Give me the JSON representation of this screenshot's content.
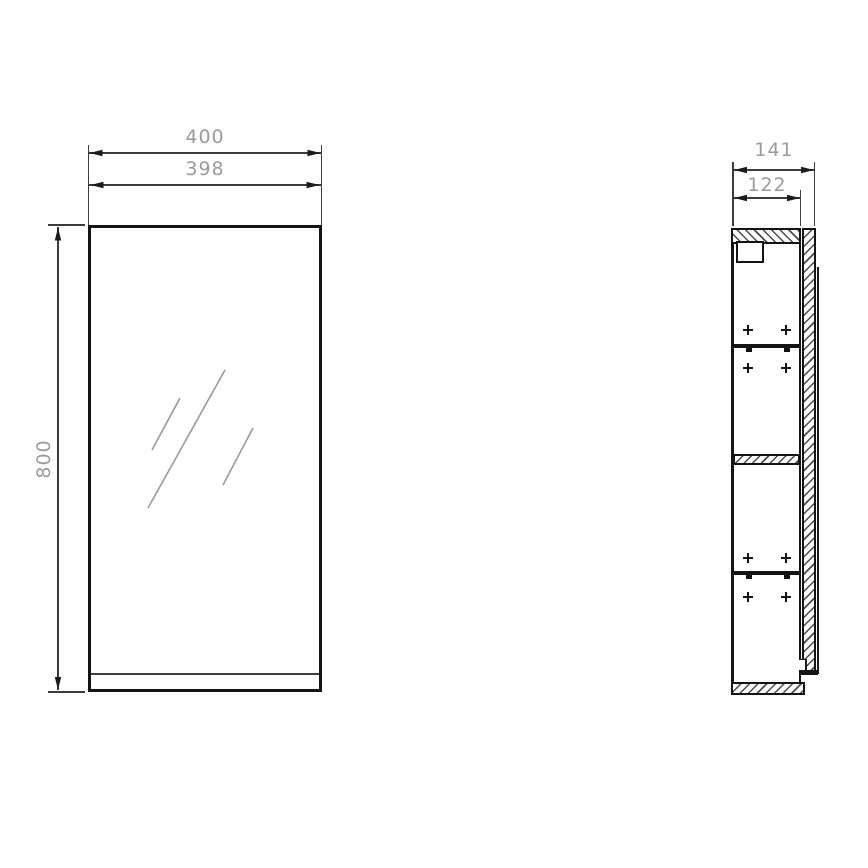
{
  "views": {
    "front": {
      "name": "front-view",
      "dimensions": [
        {
          "label": "400",
          "axis": "horizontal",
          "measures": "overall-width"
        },
        {
          "label": "398",
          "axis": "horizontal",
          "measures": "door-width"
        },
        {
          "label": "800",
          "axis": "vertical",
          "measures": "overall-height"
        }
      ],
      "reflection_marks": 3
    },
    "side": {
      "name": "side-section-view",
      "dimensions": [
        {
          "label": "141",
          "axis": "horizontal",
          "measures": "overall-depth"
        },
        {
          "label": "122",
          "axis": "horizontal",
          "measures": "body-depth"
        }
      ],
      "shelf_pin_mark_rows": 4,
      "adjustable_shelves": 2,
      "fixed_shelves": 1
    }
  },
  "icons": {
    "shelf_pin_marker": "plus-cross"
  },
  "colors": {
    "object_line": "#141414",
    "dimension_line": "#3c3c3c",
    "dimension_text": "#9b9b9b",
    "mirror_mark": "#9a9a9a",
    "background": "#ffffff"
  }
}
